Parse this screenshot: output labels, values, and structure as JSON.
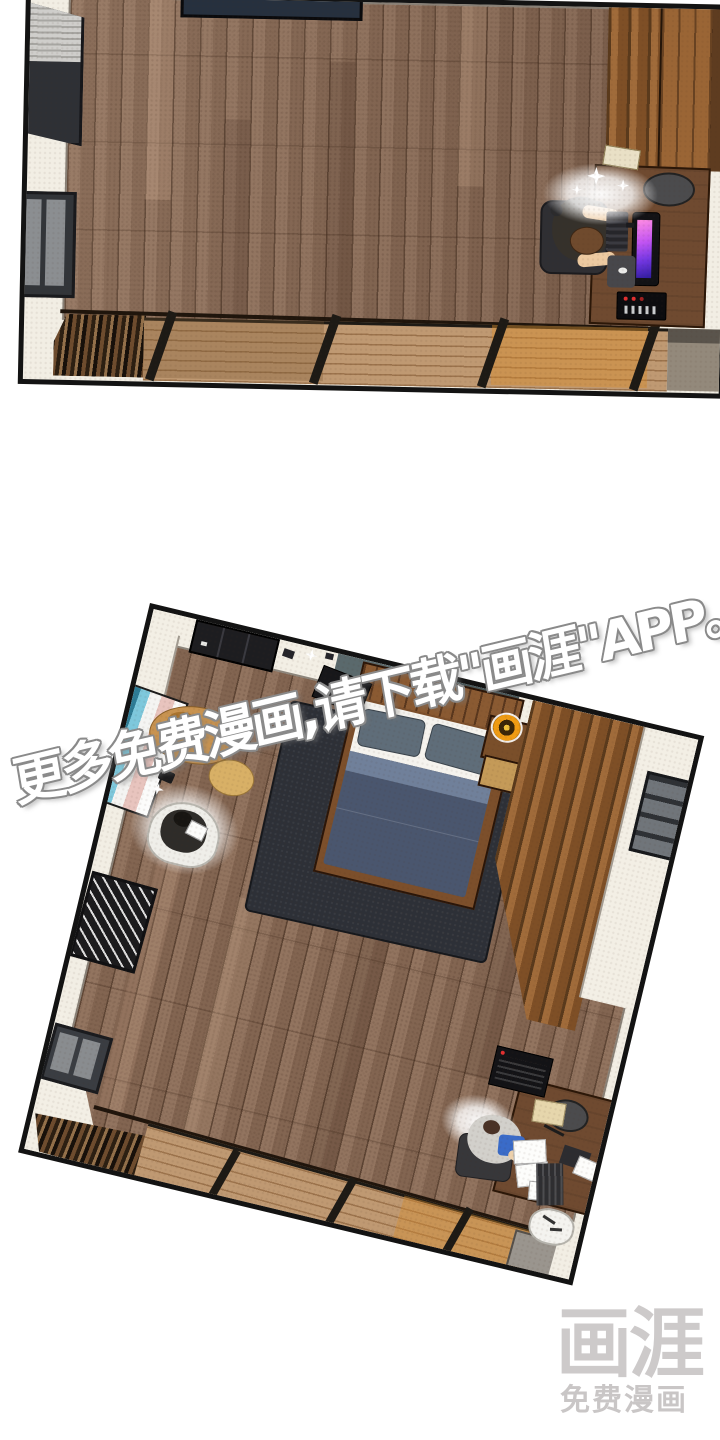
{
  "page": {
    "background_color": "#ffffff",
    "width": 720,
    "height": 1440,
    "kind": "webtoon comic page, two top-down room panels"
  },
  "watermark": {
    "text": "更多免费漫画,请下载\"画涯\"APP。",
    "text_color": "#ffffff",
    "outline_color": "#8a8a8a",
    "rotation_deg": -13.5
  },
  "logo": {
    "title": "画涯",
    "subtitle": "免费漫画",
    "color": "#cdcaca"
  },
  "palette": {
    "panel_border": "#131313",
    "wall_cream": "#f2eee4",
    "floor_wood": "#8b6c57",
    "partition_wood": "#a06b3a",
    "closet_wood": "#9a6535",
    "genkan_mat_tan": "#bf9972",
    "genkan_mat_amber": "#c88d44",
    "desk_wood": "#6f4a30",
    "duvet_navy": "#4a566e",
    "pillow_slate": "#5f6d79",
    "rug_charcoal": "#2d3037",
    "teal_wall": "#5a696c",
    "monitor_screen": "#c355f2",
    "clock_orange": "#ef9b13",
    "shorts_blue": "#3a6bc8",
    "dog_tan": "#c89350"
  },
  "panels": [
    {
      "id": "panel-1",
      "rotation_deg": 1.2,
      "description": "top-down view of room corner: person in office chair at wooden desk with glowing pink-purple monitor, keyboard, mouse pad, console, wood slat partition and closet, windows on left wall, tatami entry mats at bottom"
    },
    {
      "id": "panel-2",
      "rotation_deg": 13.5,
      "description": "tilted top-down view of same bedroom: bed with navy duvet and slate pillows on charcoal rug, orange clock on nightstand, sleeping dog, person on white floor chair with glow, striped art on left wall, wood slat partition, desk with person in hoodie and blue shorts, scattered papers, entry mats"
    }
  ]
}
